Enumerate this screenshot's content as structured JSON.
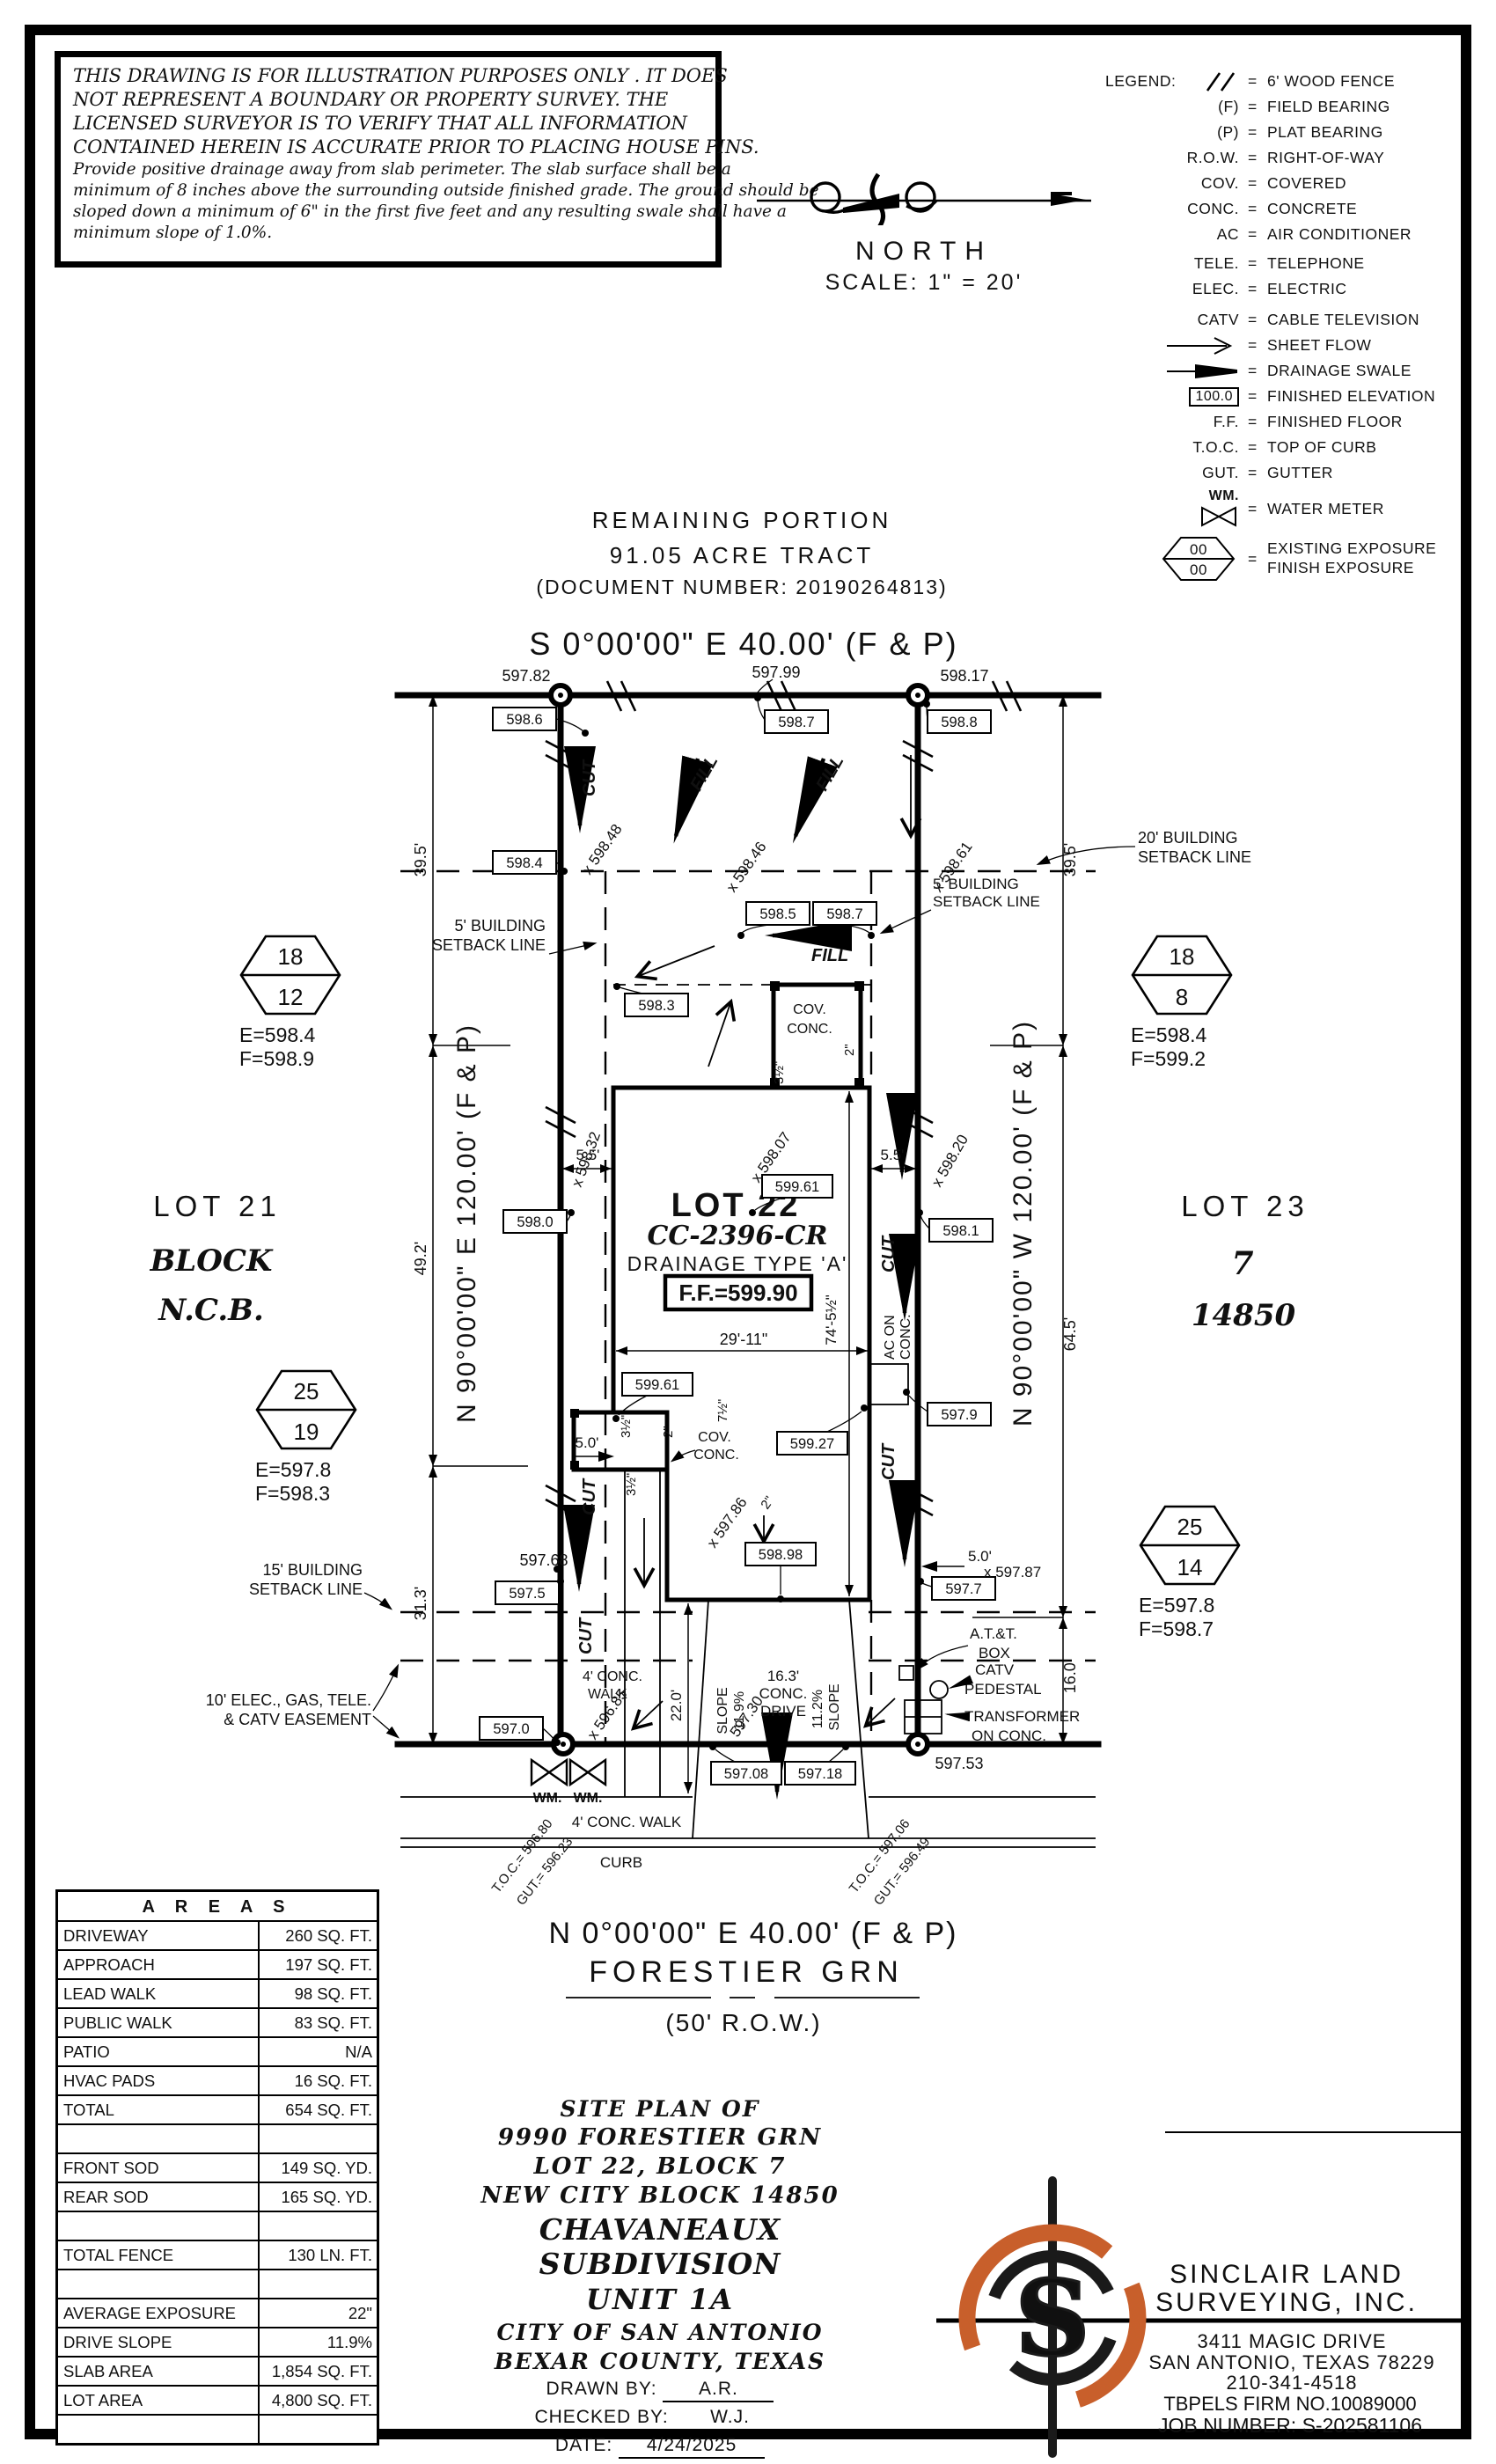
{
  "disclaimer": {
    "p1": [
      "THIS DRAWING IS FOR ILLUSTRATION PURPOSES ONLY . IT DOES",
      "NOT REPRESENT A BOUNDARY OR PROPERTY SURVEY. THE",
      "LICENSED SURVEYOR IS TO VERIFY THAT ALL INFORMATION",
      "CONTAINED HEREIN IS ACCURATE PRIOR TO PLACING HOUSE PINS."
    ],
    "p2": [
      "Provide positive drainage away from slab perimeter. The slab surface shall be a",
      "minimum of 8 inches above the surrounding outside finished grade. The ground should be",
      "sloped down a minimum of 6\" in the first five feet and any resulting swale shall have a",
      "minimum slope of 1.0%."
    ]
  },
  "north": {
    "label": "NORTH",
    "scale": "SCALE: 1\" = 20'"
  },
  "legend": {
    "title": "LEGEND:",
    "eq": "=",
    "items": [
      {
        "key": "\\\\",
        "label": "6' WOOD FENCE"
      },
      {
        "key": "(F)",
        "label": "FIELD BEARING"
      },
      {
        "key": "(P)",
        "label": "PLAT BEARING"
      },
      {
        "key": "R.O.W.",
        "label": "RIGHT-OF-WAY"
      },
      {
        "key": "COV.",
        "label": "COVERED"
      },
      {
        "key": "CONC.",
        "label": "CONCRETE"
      },
      {
        "key": "AC",
        "label": "AIR CONDITIONER"
      },
      {
        "key": "TELE.",
        "label": "TELEPHONE"
      },
      {
        "key": "ELEC.",
        "label": "ELECTRIC"
      },
      {
        "key": "CATV",
        "label": "CABLE TELEVISION"
      },
      {
        "key": "",
        "label": "SHEET FLOW"
      },
      {
        "key": "",
        "label": "DRAINAGE SWALE"
      },
      {
        "key": "100.0",
        "label": "FINISHED ELEVATION"
      },
      {
        "key": "F.F.",
        "label": "FINISHED FLOOR"
      },
      {
        "key": "T.O.C.",
        "label": "TOP OF CURB"
      },
      {
        "key": "GUT.",
        "label": "GUTTER"
      },
      {
        "key": "WM.",
        "label": "WATER METER"
      },
      {
        "key": "00",
        "key2": "00",
        "label": "EXISTING EXPOSURE",
        "label2": "FINISH EXPOSURE"
      }
    ]
  },
  "tract": {
    "line1": "REMAINING PORTION",
    "line2": "91.05 ACRE TRACT",
    "line3": "(DOCUMENT NUMBER: 20190264813)"
  },
  "plan": {
    "bearing_top": "S 0°00'00\" E 40.00' (F & P)",
    "bearing_bottom": "N 0°00'00\" E 40.00' (F & P)",
    "bearing_left": "N 90°00'00\" E 120.00' (F & P)",
    "bearing_right": "N 90°00'00\" W 120.00' (F & P)",
    "street_name": "FORESTIER GRN",
    "street_row": "(50' R.O.W.)",
    "lot_title": "LOT 22",
    "lot_code": "CC-2396-CR",
    "lot_drainage": "DRAINAGE TYPE 'A'",
    "lot_ff": "F.F.=599.90",
    "nb_left_1": "LOT 21",
    "nb_left_2": "BLOCK",
    "nb_left_3": "N.C.B.",
    "nb_right_1": "LOT 23",
    "nb_right_2": "7",
    "nb_right_3": "14850",
    "hexes": [
      {
        "top": "18",
        "bot": "12",
        "e": "E=598.4",
        "f": "F=598.9"
      },
      {
        "top": "18",
        "bot": "8",
        "e": "E=598.4",
        "f": "F=599.2"
      },
      {
        "top": "25",
        "bot": "19",
        "e": "E=597.8",
        "f": "F=598.3"
      },
      {
        "top": "25",
        "bot": "14",
        "e": "E=597.8",
        "f": "F=598.7"
      }
    ],
    "boxes": [
      "598.6",
      "598.7",
      "598.8",
      "598.4",
      "598.5",
      "598.7",
      "598.3",
      "599.61",
      "598.0",
      "598.1",
      "599.61",
      "599.27",
      "597.9",
      "598.98",
      "597.7",
      "597.5",
      "597.0",
      "597.08",
      "597.18"
    ],
    "spots": {
      "s1": "597.82",
      "s2": "597.99",
      "s3": "598.17",
      "s4": "597.68",
      "s5": "597.53",
      "s6": "597.30",
      "x1": "x 598.48",
      "x2": "x 598.46",
      "x3": "x 598.61",
      "x4": "x 598.32",
      "x5": "x 598.07",
      "x6": "x 598.20",
      "x7": "x 597.86",
      "x8": "x 597.87",
      "x9": "x 596.85"
    },
    "dims": {
      "d395": "39.5'",
      "d492": "49.2'",
      "d313": "31.3'",
      "d645": "64.5'",
      "d160": "16.0'",
      "d55": "5.5'",
      "d745": "74'-5½\"",
      "d2911": "29'-11\"",
      "d50": "5.0'",
      "d220": "22.0'",
      "d35": "3½\"",
      "d2": "2\"",
      "d75": "7½\"",
      "d163": "16.3'",
      "conc": "CONC.",
      "drive": "DRIVE",
      "slope": "SLOPE",
      "s119": "11.9%",
      "s112": "11.2%"
    },
    "sb": {
      "five1": "5' BUILDING",
      "five2": "SETBACK LINE",
      "twenty": "20' BUILDING",
      "fifteen": "15' BUILDING",
      "ease1": "10' ELEC., GAS, TELE.",
      "ease2": "& CATV EASEMENT"
    },
    "util": {
      "att1": "A.T.&T.",
      "att2": "BOX",
      "catv": "CATV",
      "ped": "PEDESTAL",
      "tr1": "TRANSFORMER",
      "tr2": "ON CONC.",
      "ac1": "AC ON",
      "ac2": "CONC.",
      "wm": "WM."
    },
    "misc": {
      "cov": "COV.",
      "conc": "CONC.",
      "walk4": "4' CONC.",
      "walk": "WALK",
      "pubwalk": "4' CONC. WALK",
      "curb": "CURB",
      "cut": "CUT",
      "fill": "FILL",
      "toc_l": "T.O.C.= 596.80",
      "gut_l": "GUT.= 596.23",
      "toc_r": "T.O.C.= 597.06",
      "gut_r": "GUT.= 596.49"
    }
  },
  "areas_table": {
    "title": "A R E A S",
    "rows": [
      {
        "label": "DRIVEWAY",
        "value": "260 SQ. FT."
      },
      {
        "label": "APPROACH",
        "value": "197 SQ. FT."
      },
      {
        "label": "LEAD WALK",
        "value": "98 SQ. FT."
      },
      {
        "label": "PUBLIC WALK",
        "value": "83 SQ. FT."
      },
      {
        "label": "PATIO",
        "value": "N/A"
      },
      {
        "label": "HVAC PADS",
        "value": "16 SQ. FT."
      },
      {
        "label": "TOTAL",
        "value": "654 SQ. FT."
      },
      {
        "label": "",
        "value": ""
      },
      {
        "label": "FRONT SOD",
        "value": "149 SQ. YD."
      },
      {
        "label": "REAR SOD",
        "value": "165 SQ. YD."
      },
      {
        "label": "",
        "value": ""
      },
      {
        "label": "TOTAL FENCE",
        "value": "130 LN. FT."
      },
      {
        "label": "",
        "value": ""
      },
      {
        "label": "AVERAGE EXPOSURE",
        "value": "22\""
      },
      {
        "label": "DRIVE SLOPE",
        "value": "11.9%"
      },
      {
        "label": "SLAB AREA",
        "value": "1,854 SQ. FT."
      },
      {
        "label": "LOT AREA",
        "value": "4,800 SQ. FT."
      },
      {
        "label": "",
        "value": ""
      }
    ]
  },
  "title_block": {
    "line1": "SITE PLAN OF",
    "line2": "9990 FORESTIER GRN",
    "line3": "LOT 22, BLOCK 7",
    "line4": "NEW CITY BLOCK 14850",
    "line5": "CHAVANEAUX SUBDIVISION",
    "line6": "UNIT 1A",
    "line7": "CITY OF SAN ANTONIO",
    "line8": "BEXAR COUNTY, TEXAS",
    "drawn_label": "DRAWN BY:",
    "drawn": "A.R.",
    "checked_label": "CHECKED BY:",
    "checked": "W.J.",
    "date_label": "DATE:",
    "date": "4/24/2025"
  },
  "firm": {
    "name1": "SINCLAIR LAND",
    "name2": "SURVEYING, INC.",
    "addr1": "3411 MAGIC DRIVE",
    "addr2": "SAN ANTONIO, TEXAS 78229",
    "phone": "210-341-4518",
    "firm_no": "TBPELS FIRM NO.10089000",
    "job": "JOB NUMBER: S-202581106",
    "logo_letter": "S",
    "accent": "#c85f2b"
  }
}
